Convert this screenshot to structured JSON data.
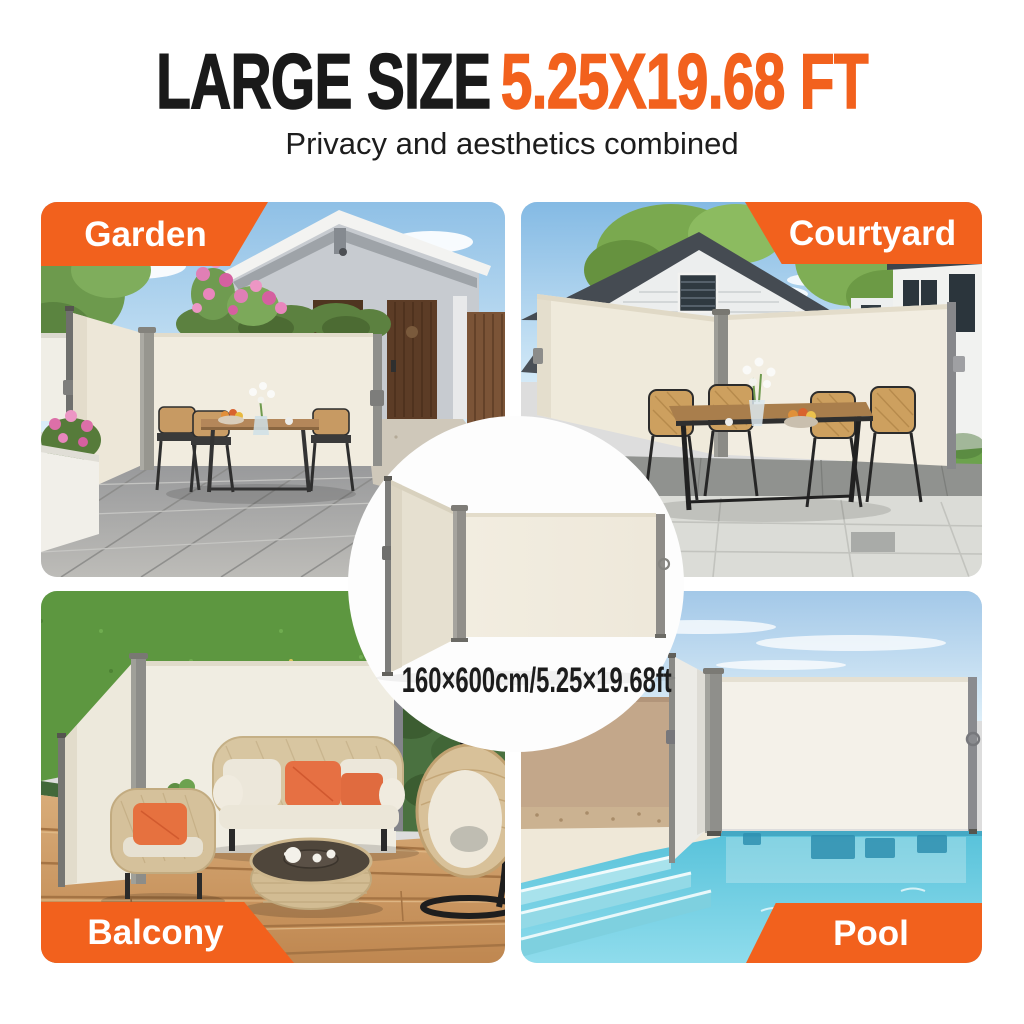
{
  "header": {
    "title_black": "LARGE SIZE",
    "title_orange": "5.25X19.68 FT",
    "subtitle": "Privacy and aesthetics combined"
  },
  "panels": [
    {
      "id": "garden",
      "label": "Garden"
    },
    {
      "id": "courtyard",
      "label": "Courtyard"
    },
    {
      "id": "balcony",
      "label": "Balcony"
    },
    {
      "id": "pool",
      "label": "Pool"
    }
  ],
  "center_badge": {
    "dimension_text": "160×600cm/5.25×19.68ft"
  },
  "colors": {
    "accent_orange": "#F2611D",
    "awning_beige": "#F0EBDE",
    "post_gray": "#8E8E8A",
    "title_black": "#1A1A1A"
  }
}
